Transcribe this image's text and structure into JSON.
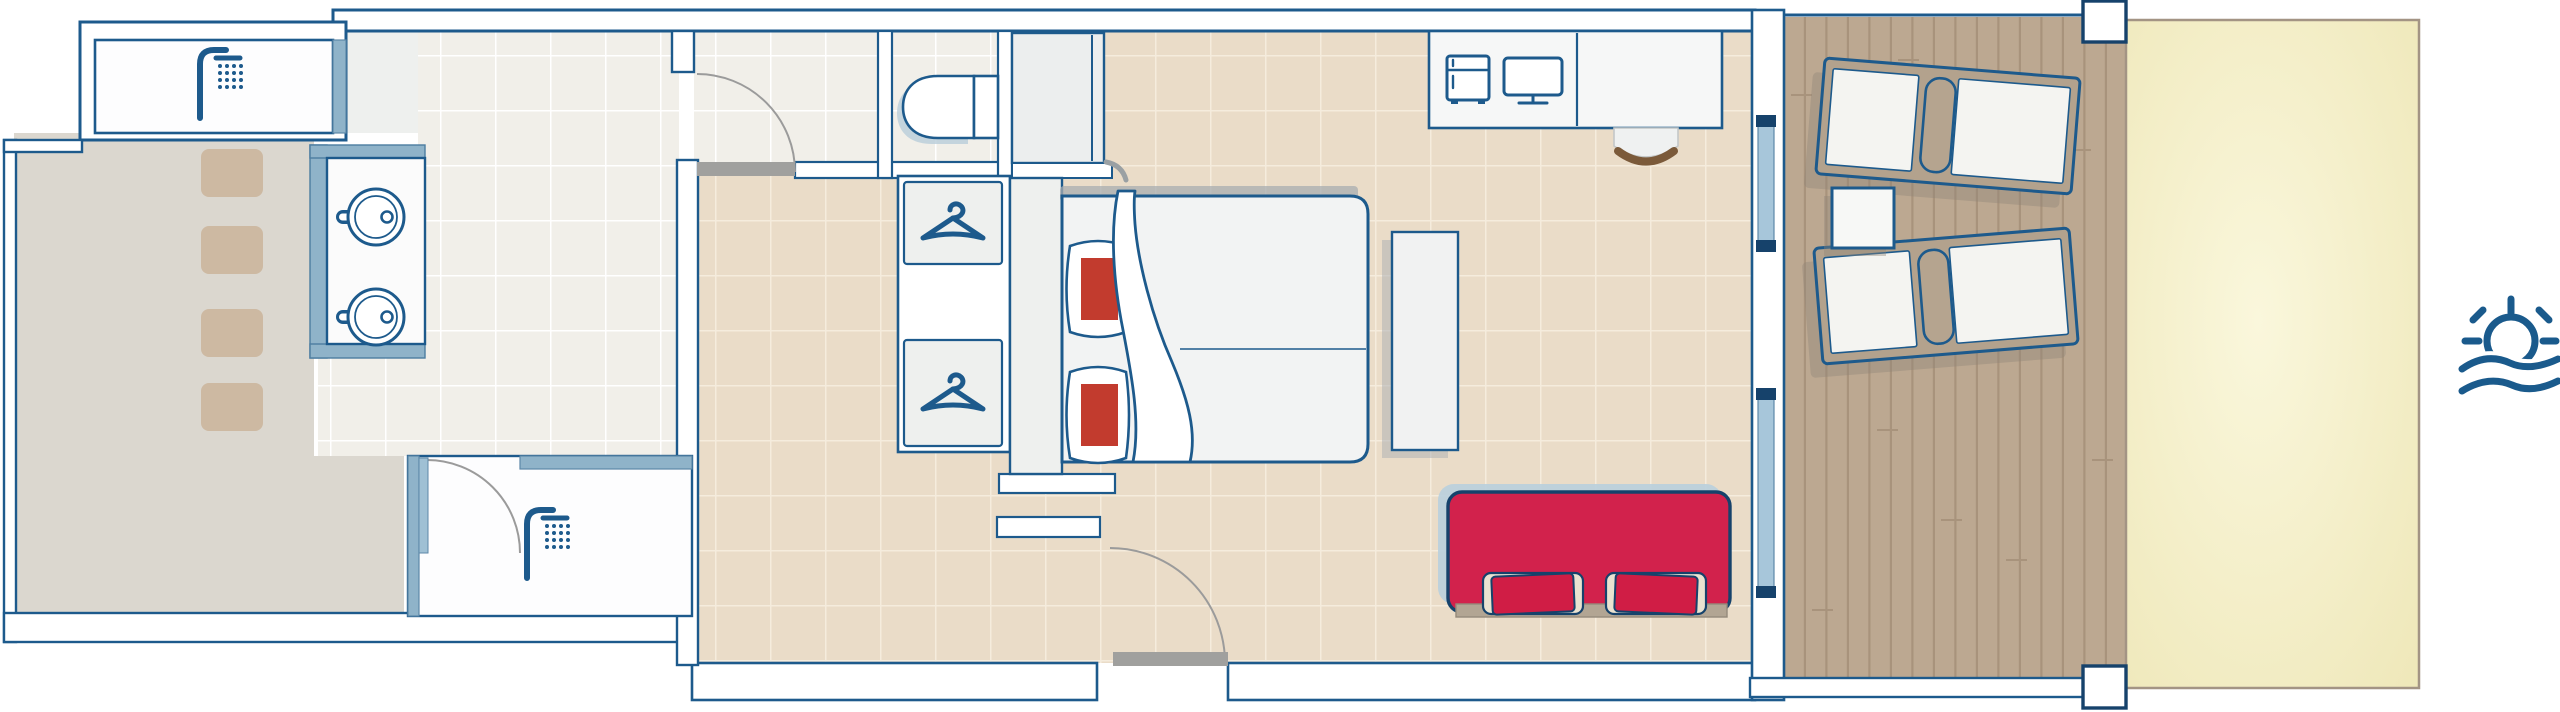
{
  "plan": {
    "kind": "hotel-room-floor-plan",
    "orientation": "top-down",
    "rooms": [
      "outdoor-courtyard",
      "outdoor-shower-room",
      "bathroom",
      "inner-shower-room",
      "toilet-nook",
      "hallway",
      "bedroom",
      "wooden-deck",
      "sand-area"
    ],
    "fixture_counts": {
      "showers": 2,
      "sinks": 2,
      "toilets": 1,
      "wardrobe_hangers": 2,
      "stepping_stones": 4,
      "bed_pillows": 2,
      "sofa_cushions": 2,
      "sun_loungers": 2,
      "side_tables": 1,
      "sliding_glass_doors": 2,
      "deck_posts": 2,
      "door_swings": 4
    }
  },
  "colors": {
    "outline": "#1d5a8c",
    "outline_dark": "#16426b",
    "wall_fill": "#ffffff",
    "wet_wall": "#8fb3c9",
    "glass": "#a7c6da",
    "bath_tile": "#f1efe9",
    "bath_grout": "#ffffff",
    "room_tile": "#eadcc8",
    "room_grout": "#f5ecdd",
    "courtyard": "#dbd7cf",
    "stepping_stone": "#cdb9a2",
    "wood": "#bca891",
    "wood_line": "#a8937c",
    "sand": "#f0eabe",
    "sand_hl": "#faf7dc",
    "sand_border": "#a39484",
    "fixture_fill": "#fdfdfe",
    "furniture_fill": "#eff1f1",
    "sofa": "#d2224c",
    "cushion_red": "#d01d45",
    "cushion_trim": "#eae2d0",
    "pillow_red": "#c23b2e",
    "shadow_blue": "#b9cdd9",
    "shadow_grey": "#a8adb0",
    "door_leaf": "#a0a09e",
    "door_arc": "#9b9b9b",
    "chair_wood": "#7b5a3a",
    "lounger_frame": "#b3a28d",
    "icon_blue": "#1a5a8c"
  },
  "icons": [
    "shower-icon",
    "sink-icon",
    "toilet-icon",
    "hanger-icon",
    "mini-fridge-icon",
    "tv-icon",
    "sun-over-sea-icon"
  ]
}
